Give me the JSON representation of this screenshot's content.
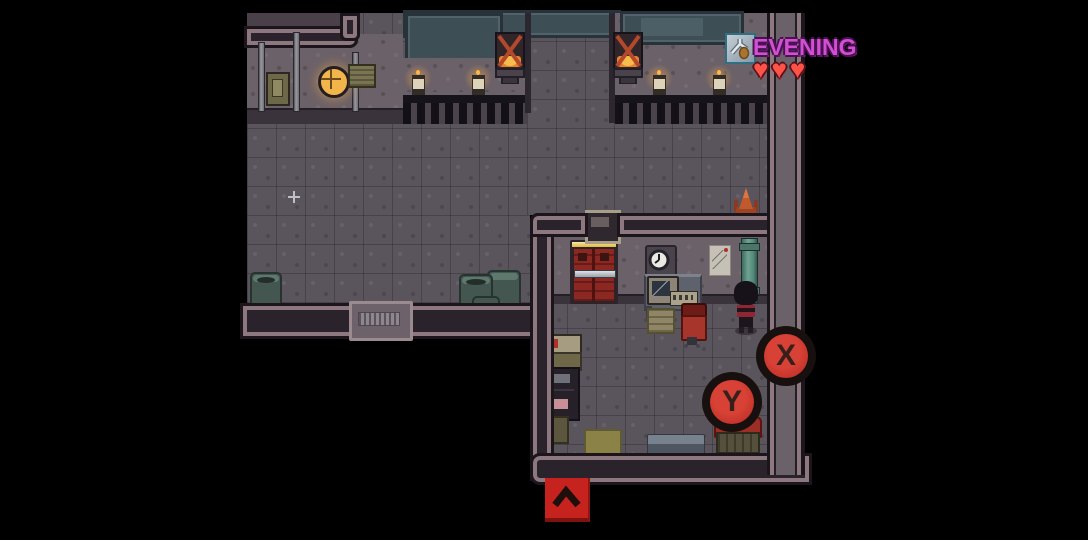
{
  "hud": {
    "time_label": "EVENING",
    "weapon_slot": {
      "icon": "slingshot-icon"
    },
    "hearts": {
      "glyph": "♥",
      "count": 3
    },
    "buttons": {
      "x_label": "X",
      "y_label": "Y",
      "up_button_icon": "chevron-up-icon"
    },
    "colors": {
      "time_text": "#d24fd2",
      "heart": "#ff5348",
      "action_button_red": "#c93329",
      "action_button_ring": "#17100e",
      "up_button_red": "#c6231f"
    }
  },
  "scene": {
    "description": "Top-down pixel-art facility interior at evening: a large hall with windows, furnaces and candle radiators, a north corridor, and a small office room with a red door, desk, computer and a dark-haired character.",
    "rooms": [
      "main-hall",
      "north-corridor",
      "office"
    ],
    "objects": [
      "window-panel",
      "furnace",
      "candle-jar",
      "radiator-railing",
      "wall-lamp",
      "electrical-box",
      "wall-pipes",
      "barrels",
      "entry-step-mat",
      "red-exit-door",
      "door-sign",
      "wall-clock",
      "wall-poster",
      "green-pipe",
      "computer-desk",
      "monitor",
      "keyboard",
      "office-chair",
      "storage-shelves",
      "crates",
      "floor-mats",
      "red-bench",
      "traffic-cone",
      "player-character",
      "floor-sparkle"
    ],
    "palette": {
      "floor": "#5a545d",
      "wall_face": "#6b6168",
      "wall_outline_dark": "#1c161c",
      "wall_outline_light": "#8d7880",
      "window_teal": "#3e4e55",
      "door_red": "#8c2722",
      "pipe_green": "#55897b",
      "fire_glow": "#f0922f",
      "barrel_teal": "#43564f",
      "outside": "#000000"
    }
  }
}
